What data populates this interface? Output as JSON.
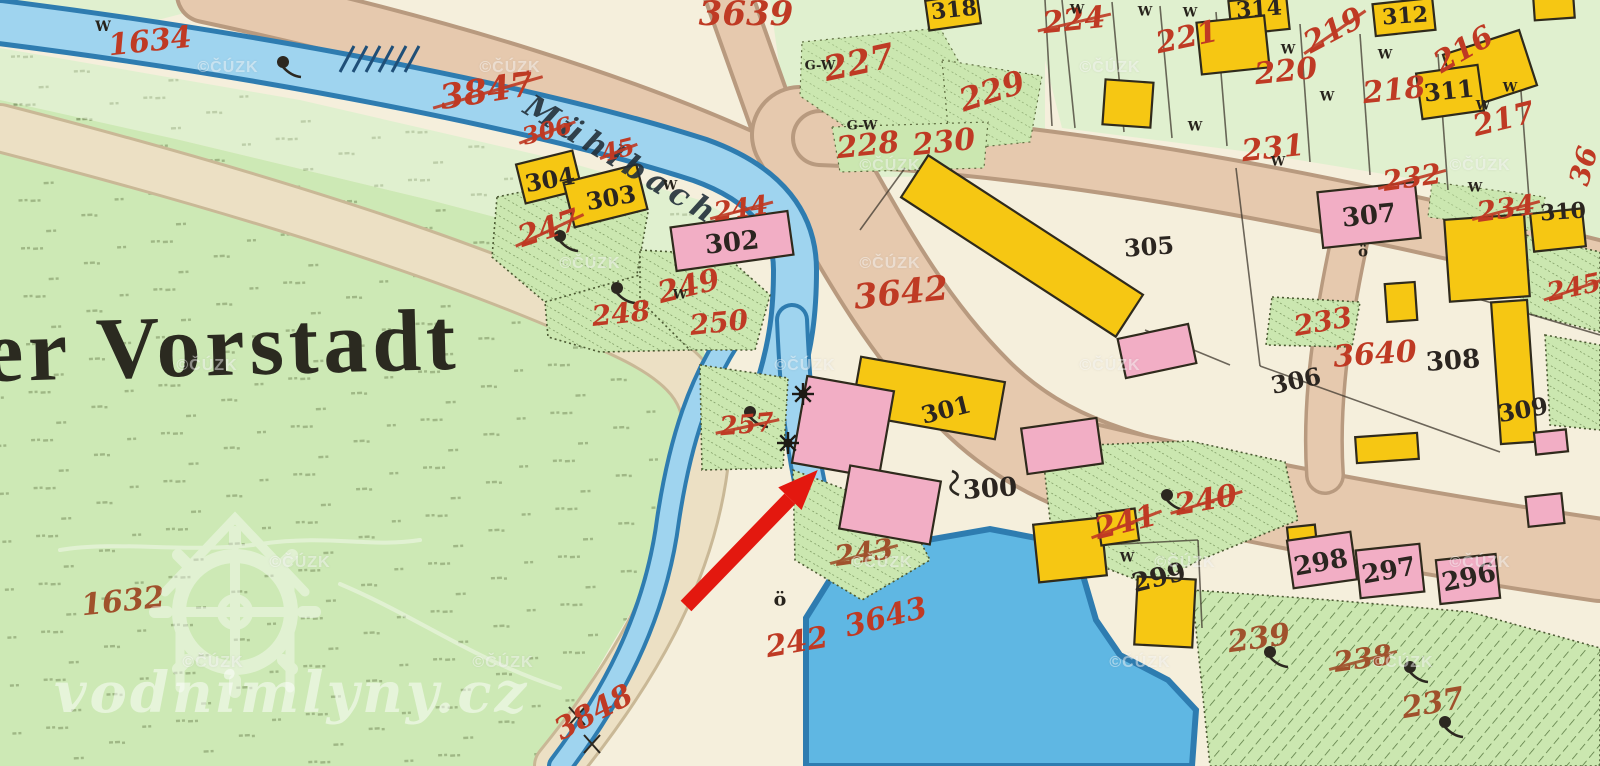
{
  "map": {
    "region_name": "er Vorstadt",
    "stream_name": "Mühlbach",
    "palette": {
      "cream": "#f5efdc",
      "meadow": "#cde9b5",
      "paleGreen": "#e0f0cf",
      "hatchGreen": "#cbe7b0",
      "road": "#e6c9ae",
      "roadEdge": "#b89a7f",
      "water": "#9fd4ef",
      "waterDark": "#2e7cb0",
      "pond": "#5fb7e3",
      "yellow": "#f6c713",
      "pink": "#f2aec5",
      "redInk": "#bf3a24",
      "brownInk": "#a0512c",
      "blackInk": "#2b2520",
      "arrowRed": "#e3180f"
    },
    "parcel_labels": [
      {
        "text": "1634",
        "x": 150,
        "y": 42,
        "size": 30,
        "rot": -6,
        "ink": "red",
        "struck": false
      },
      {
        "text": "3847",
        "x": 487,
        "y": 91,
        "size": 34,
        "rot": -9,
        "ink": "red",
        "struck": true
      },
      {
        "text": "306",
        "x": 547,
        "y": 131,
        "size": 24,
        "rot": -14,
        "ink": "red",
        "struck": true
      },
      {
        "text": "45",
        "x": 618,
        "y": 150,
        "size": 24,
        "rot": -14,
        "ink": "red",
        "struck": true
      },
      {
        "text": "247",
        "x": 549,
        "y": 229,
        "size": 30,
        "rot": -18,
        "ink": "red",
        "struck": true
      },
      {
        "text": "244",
        "x": 741,
        "y": 209,
        "size": 26,
        "rot": -8,
        "ink": "red",
        "struck": true
      },
      {
        "text": "249",
        "x": 689,
        "y": 287,
        "size": 30,
        "rot": -14,
        "ink": "red",
        "struck": false
      },
      {
        "text": "248",
        "x": 621,
        "y": 314,
        "size": 28,
        "rot": -6,
        "ink": "red",
        "struck": false
      },
      {
        "text": "250",
        "x": 719,
        "y": 323,
        "size": 28,
        "rot": -6,
        "ink": "red",
        "struck": false
      },
      {
        "text": "257",
        "x": 747,
        "y": 425,
        "size": 26,
        "rot": -5,
        "ink": "red",
        "struck": true
      },
      {
        "text": "3642",
        "x": 901,
        "y": 293,
        "size": 34,
        "rot": -6,
        "ink": "red",
        "struck": false
      },
      {
        "text": "243",
        "x": 864,
        "y": 553,
        "size": 28,
        "rot": -8,
        "ink": "brown",
        "struck": true
      },
      {
        "text": "3643",
        "x": 886,
        "y": 618,
        "size": 30,
        "rot": -14,
        "ink": "red",
        "struck": false
      },
      {
        "text": "242",
        "x": 797,
        "y": 643,
        "size": 30,
        "rot": -10,
        "ink": "red",
        "struck": false
      },
      {
        "text": "3848",
        "x": 594,
        "y": 713,
        "size": 30,
        "rot": -28,
        "ink": "red",
        "struck": false
      },
      {
        "text": "1632",
        "x": 123,
        "y": 602,
        "size": 30,
        "rot": -6,
        "ink": "brown",
        "struck": false
      },
      {
        "text": "3639",
        "x": 746,
        "y": 14,
        "size": 34,
        "rot": 0,
        "ink": "red",
        "struck": false
      },
      {
        "text": "227",
        "x": 859,
        "y": 63,
        "size": 34,
        "rot": -12,
        "ink": "red",
        "struck": false
      },
      {
        "text": "228",
        "x": 868,
        "y": 146,
        "size": 30,
        "rot": -6,
        "ink": "red",
        "struck": false
      },
      {
        "text": "230",
        "x": 944,
        "y": 143,
        "size": 30,
        "rot": -6,
        "ink": "red",
        "struck": false
      },
      {
        "text": "229",
        "x": 992,
        "y": 91,
        "size": 32,
        "rot": -18,
        "ink": "red",
        "struck": false
      },
      {
        "text": "224",
        "x": 1074,
        "y": 21,
        "size": 30,
        "rot": -6,
        "ink": "red",
        "struck": true
      },
      {
        "text": "221",
        "x": 1187,
        "y": 38,
        "size": 30,
        "rot": -12,
        "ink": "red",
        "struck": false
      },
      {
        "text": "220",
        "x": 1286,
        "y": 72,
        "size": 30,
        "rot": -6,
        "ink": "red",
        "struck": false
      },
      {
        "text": "219",
        "x": 1334,
        "y": 31,
        "size": 30,
        "rot": -28,
        "ink": "red",
        "struck": true
      },
      {
        "text": "216",
        "x": 1464,
        "y": 50,
        "size": 30,
        "rot": -30,
        "ink": "red",
        "struck": false
      },
      {
        "text": "218",
        "x": 1394,
        "y": 91,
        "size": 30,
        "rot": -6,
        "ink": "red",
        "struck": false
      },
      {
        "text": "217",
        "x": 1504,
        "y": 120,
        "size": 30,
        "rot": -14,
        "ink": "red",
        "struck": false
      },
      {
        "text": "231",
        "x": 1273,
        "y": 149,
        "size": 30,
        "rot": -6,
        "ink": "red",
        "struck": false
      },
      {
        "text": "232",
        "x": 1412,
        "y": 178,
        "size": 28,
        "rot": -8,
        "ink": "red",
        "struck": true
      },
      {
        "text": "234",
        "x": 1506,
        "y": 209,
        "size": 28,
        "rot": -8,
        "ink": "red",
        "struck": true
      },
      {
        "text": "36",
        "x": 1584,
        "y": 166,
        "size": 28,
        "rot": -75,
        "ink": "red",
        "struck": false
      },
      {
        "text": "245",
        "x": 1574,
        "y": 288,
        "size": 26,
        "rot": -12,
        "ink": "red",
        "struck": true
      },
      {
        "text": "233",
        "x": 1323,
        "y": 322,
        "size": 28,
        "rot": -10,
        "ink": "red",
        "struck": false
      },
      {
        "text": "3640",
        "x": 1375,
        "y": 355,
        "size": 30,
        "rot": -4,
        "ink": "red",
        "struck": false
      },
      {
        "text": "240",
        "x": 1206,
        "y": 501,
        "size": 30,
        "rot": -10,
        "ink": "red",
        "struck": true
      },
      {
        "text": "241",
        "x": 1126,
        "y": 523,
        "size": 30,
        "rot": -14,
        "ink": "red",
        "struck": true
      },
      {
        "text": "239",
        "x": 1259,
        "y": 639,
        "size": 30,
        "rot": -8,
        "ink": "brown",
        "struck": false
      },
      {
        "text": "238",
        "x": 1363,
        "y": 659,
        "size": 28,
        "rot": -8,
        "ink": "brown",
        "struck": true
      },
      {
        "text": "237",
        "x": 1433,
        "y": 704,
        "size": 30,
        "rot": -10,
        "ink": "brown",
        "struck": false
      },
      {
        "text": "304",
        "x": 550,
        "y": 180,
        "size": 24,
        "rot": -10,
        "ink": "black",
        "struck": false
      },
      {
        "text": "303",
        "x": 611,
        "y": 198,
        "size": 24,
        "rot": -10,
        "ink": "black",
        "struck": false
      },
      {
        "text": "302",
        "x": 732,
        "y": 243,
        "size": 26,
        "rot": -6,
        "ink": "black",
        "struck": false
      },
      {
        "text": "301",
        "x": 946,
        "y": 410,
        "size": 24,
        "rot": -14,
        "ink": "black",
        "struck": false
      },
      {
        "text": "300",
        "x": 990,
        "y": 489,
        "size": 26,
        "rot": -4,
        "ink": "black",
        "struck": false
      },
      {
        "text": "305",
        "x": 1149,
        "y": 247,
        "size": 24,
        "rot": -4,
        "ink": "black",
        "struck": false
      },
      {
        "text": "307",
        "x": 1369,
        "y": 216,
        "size": 26,
        "rot": -6,
        "ink": "black",
        "struck": false
      },
      {
        "text": "310",
        "x": 1563,
        "y": 212,
        "size": 22,
        "rot": -4,
        "ink": "black",
        "struck": false
      },
      {
        "text": "311",
        "x": 1449,
        "y": 91,
        "size": 24,
        "rot": -6,
        "ink": "black",
        "struck": false
      },
      {
        "text": "312",
        "x": 1405,
        "y": 16,
        "size": 22,
        "rot": -4,
        "ink": "black",
        "struck": false
      },
      {
        "text": "314",
        "x": 1259,
        "y": 9,
        "size": 22,
        "rot": -4,
        "ink": "black",
        "struck": false
      },
      {
        "text": "318",
        "x": 954,
        "y": 10,
        "size": 22,
        "rot": -6,
        "ink": "black",
        "struck": false
      },
      {
        "text": "308",
        "x": 1453,
        "y": 361,
        "size": 26,
        "rot": -4,
        "ink": "black",
        "struck": false
      },
      {
        "text": "306",
        "x": 1296,
        "y": 381,
        "size": 24,
        "rot": -12,
        "ink": "black",
        "struck": false
      },
      {
        "text": "309",
        "x": 1523,
        "y": 410,
        "size": 24,
        "rot": -10,
        "ink": "black",
        "struck": false
      },
      {
        "text": "298",
        "x": 1321,
        "y": 563,
        "size": 26,
        "rot": -10,
        "ink": "black",
        "struck": false
      },
      {
        "text": "297",
        "x": 1389,
        "y": 571,
        "size": 26,
        "rot": -10,
        "ink": "black",
        "struck": false
      },
      {
        "text": "296",
        "x": 1469,
        "y": 578,
        "size": 26,
        "rot": -12,
        "ink": "black",
        "struck": false
      },
      {
        "text": "299",
        "x": 1159,
        "y": 578,
        "size": 26,
        "rot": -14,
        "ink": "black",
        "struck": false
      }
    ],
    "letter_marks": [
      {
        "text": "W",
        "x": 103,
        "y": 27,
        "size": 14
      },
      {
        "text": "W",
        "x": 670,
        "y": 186,
        "size": 13
      },
      {
        "text": "W",
        "x": 680,
        "y": 295,
        "size": 13
      },
      {
        "text": "W",
        "x": 1077,
        "y": 10,
        "size": 13
      },
      {
        "text": "W",
        "x": 1145,
        "y": 12,
        "size": 13
      },
      {
        "text": "W",
        "x": 1190,
        "y": 13,
        "size": 13
      },
      {
        "text": "W",
        "x": 1288,
        "y": 50,
        "size": 13
      },
      {
        "text": "W",
        "x": 1327,
        "y": 97,
        "size": 13
      },
      {
        "text": "W",
        "x": 1385,
        "y": 55,
        "size": 13
      },
      {
        "text": "W",
        "x": 1510,
        "y": 88,
        "size": 13
      },
      {
        "text": "W",
        "x": 1483,
        "y": 106,
        "size": 13
      },
      {
        "text": "W",
        "x": 1195,
        "y": 127,
        "size": 13
      },
      {
        "text": "W",
        "x": 1278,
        "y": 162,
        "size": 13
      },
      {
        "text": "W",
        "x": 1475,
        "y": 188,
        "size": 13
      },
      {
        "text": "W",
        "x": 1127,
        "y": 558,
        "size": 13
      },
      {
        "text": "G-W",
        "x": 820,
        "y": 66,
        "size": 13
      },
      {
        "text": "G-W",
        "x": 862,
        "y": 126,
        "size": 13
      },
      {
        "text": "ö",
        "x": 780,
        "y": 600,
        "size": 19
      },
      {
        "text": "ö",
        "x": 1363,
        "y": 252,
        "size": 15
      }
    ],
    "symbols": [
      {
        "type": "tree",
        "x": 283,
        "y": 62
      },
      {
        "type": "tree",
        "x": 560,
        "y": 236
      },
      {
        "type": "tree",
        "x": 617,
        "y": 288
      },
      {
        "type": "tree",
        "x": 750,
        "y": 412
      },
      {
        "type": "tree",
        "x": 1167,
        "y": 495
      },
      {
        "type": "tree",
        "x": 1270,
        "y": 652
      },
      {
        "type": "tree",
        "x": 1410,
        "y": 667
      },
      {
        "type": "tree",
        "x": 1445,
        "y": 722
      },
      {
        "type": "waterwheel",
        "x": 803,
        "y": 394
      },
      {
        "type": "waterwheel",
        "x": 788,
        "y": 443
      },
      {
        "type": "weir",
        "x": 375,
        "y": 58
      },
      {
        "type": "cross",
        "x": 577,
        "y": 716
      },
      {
        "type": "cross",
        "x": 592,
        "y": 744
      },
      {
        "type": "squiggle",
        "x": 958,
        "y": 483
      }
    ],
    "arrow": {
      "tail": [
        686,
        606
      ],
      "head": [
        808,
        480
      ]
    },
    "watermarks": {
      "copyright_text": "©ČÚZK",
      "site_text": "vodnimlyny.cz",
      "positions": [
        [
          228,
          68
        ],
        [
          510,
          68
        ],
        [
          1110,
          68
        ],
        [
          890,
          166
        ],
        [
          1480,
          166
        ],
        [
          590,
          264
        ],
        [
          890,
          264
        ],
        [
          207,
          366
        ],
        [
          805,
          366
        ],
        [
          1110,
          366
        ],
        [
          300,
          563
        ],
        [
          882,
          563
        ],
        [
          1185,
          563
        ],
        [
          1480,
          563
        ],
        [
          213,
          663
        ],
        [
          503,
          663
        ],
        [
          1140,
          663
        ],
        [
          1403,
          663
        ]
      ]
    }
  }
}
